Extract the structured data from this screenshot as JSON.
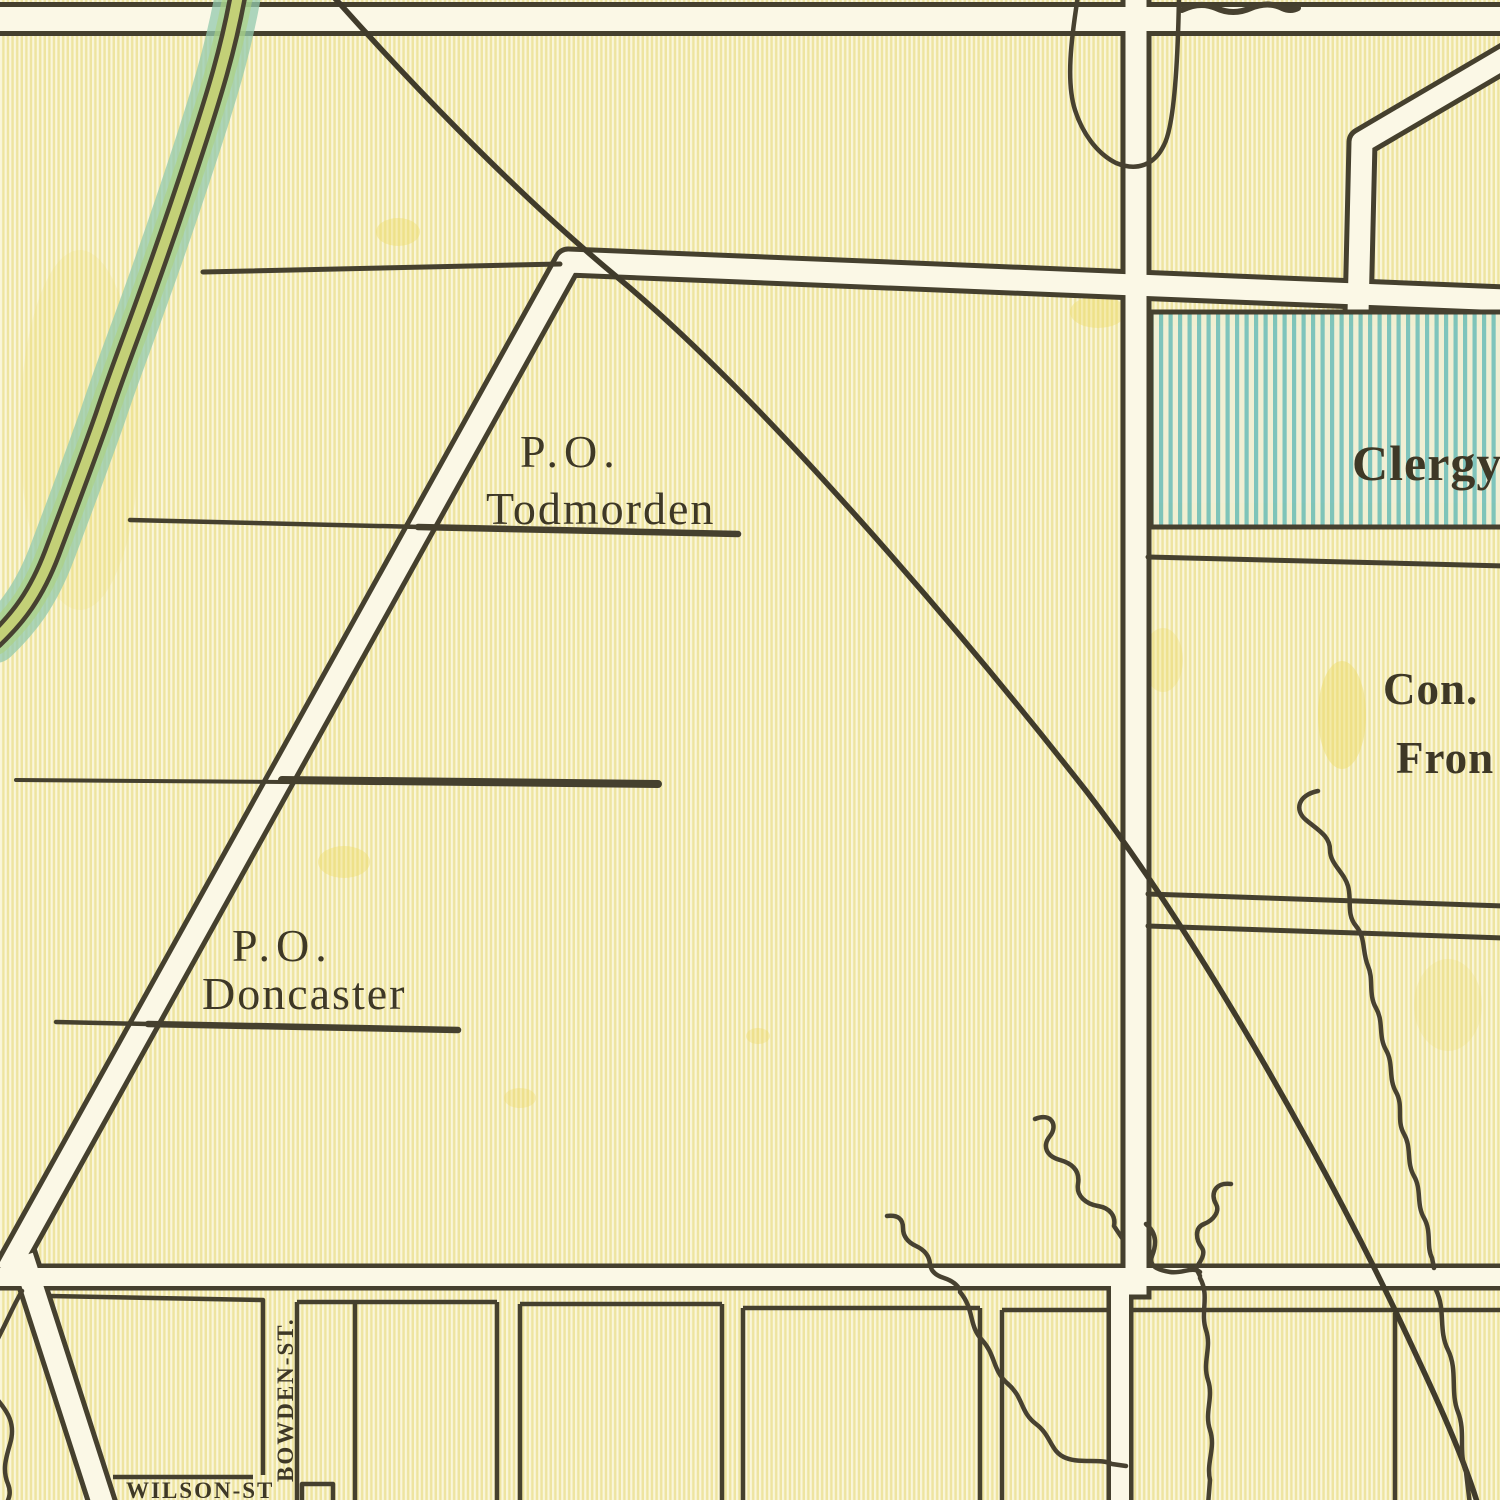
{
  "map": {
    "kind": "vintage-township-map",
    "labels": {
      "todmorden": {
        "prefix": "P.O.",
        "name": "Todmorden"
      },
      "doncaster": {
        "prefix": "P.O.",
        "name": "Doncaster"
      },
      "clergy_reserve": "Clergy",
      "concession_line1": "Con.",
      "concession_line2": "Fron",
      "bowden_street": "BOWDEN-ST.",
      "wilson_street": "WILSON-ST"
    },
    "palette": {
      "paper_base": "#f3ecb4",
      "paper_stripe_light": "#faf6da",
      "paper_stripe_dark": "#eee4a0",
      "ink": "#45402e",
      "road_fill": "#fbf8e6",
      "river_teal": "#93c9ae",
      "river_green": "#b7cc74",
      "clergy_stripe_blue": "#79c2bb",
      "stain_yellow": "#eedb67"
    }
  }
}
